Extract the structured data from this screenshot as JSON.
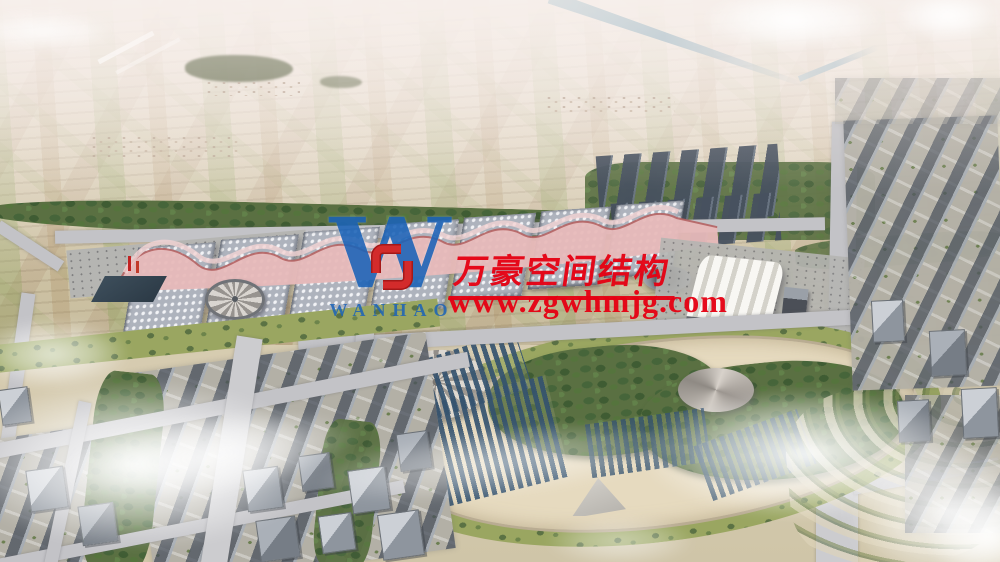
{
  "scene": {
    "description": "Aerial rendering of a large exhibition-center complex: wave-roof exhibition halls, arched station hall, oval landscaped park with solar rows, farmland plain with canal behind, city blocks in front, scattered clouds"
  },
  "watermark": {
    "brand_cn": "万豪空间结构",
    "website": "www.zgwhmjg.com",
    "logo_wordmark": "WANHAO",
    "logo_letter": "W",
    "colors": {
      "text_red": "#e60012",
      "logo_blue": "#1b63b8",
      "emblem_red": "#d32b2b"
    }
  },
  "palette": {
    "sky_haze": "#f4ece6",
    "field_tan": "#cfc2a4",
    "field_green": "#9aa86a",
    "tree_green": "#46603a",
    "roof_gray": "#b3b8c2",
    "canopy_pink": "#e3a9a9",
    "panel_blue": "#35536f",
    "road_gray": "#c3c3c7",
    "ground_beige": "#e6dabf"
  }
}
